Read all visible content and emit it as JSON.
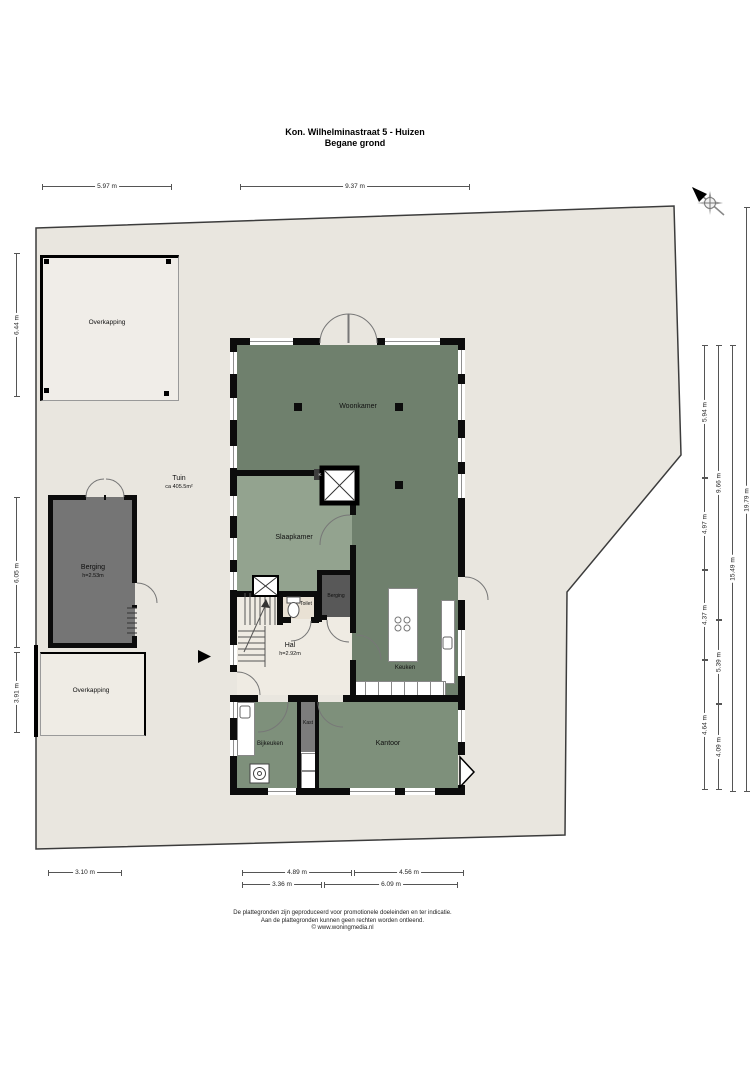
{
  "title": {
    "line1": "Kon. Wilhelminastraat 5 - Huizen",
    "line2": "Begane grond"
  },
  "rooms": {
    "woonkamer": "Woonkamer",
    "slaapkamer": "Slaapkamer",
    "toilet": "Toilet",
    "hal": {
      "name": "Hal",
      "height": "h=2.92m"
    },
    "berging_binnen": "Berging",
    "keuken": "Keuken",
    "bijkeuken": "Bijkeuken",
    "kast": "Kast",
    "kantoor": "Kantoor",
    "meterkast": "K"
  },
  "outside": {
    "overkapping_top": "Overkapping",
    "overkapping_bottom": "Overkapping",
    "berging": {
      "name": "Berging",
      "height": "h=2.53m"
    },
    "tuin": {
      "name": "Tuin",
      "area": "ca 405.5m²"
    }
  },
  "dimensions": [
    {
      "label": "5.97 m",
      "dir": "h",
      "x": 42,
      "y": 186,
      "len": 130
    },
    {
      "label": "9.37 m",
      "dir": "h",
      "x": 240,
      "y": 186,
      "len": 230
    },
    {
      "label": "3.10 m",
      "dir": "h",
      "x": 48,
      "y": 872,
      "len": 74
    },
    {
      "label": "4.89 m",
      "dir": "h",
      "x": 242,
      "y": 872,
      "len": 110
    },
    {
      "label": "4.56 m",
      "dir": "h",
      "x": 354,
      "y": 872,
      "len": 110
    },
    {
      "label": "3.36 m",
      "dir": "h",
      "x": 242,
      "y": 884,
      "len": 80
    },
    {
      "label": "6.09 m",
      "dir": "h",
      "x": 324,
      "y": 884,
      "len": 134
    },
    {
      "label": "6.44 m",
      "dir": "v",
      "x": 16,
      "y": 253,
      "len": 144
    },
    {
      "label": "6.05 m",
      "dir": "v",
      "x": 16,
      "y": 497,
      "len": 151
    },
    {
      "label": "3.91 m",
      "dir": "v",
      "x": 16,
      "y": 652,
      "len": 81
    },
    {
      "label": "5.94 m",
      "dir": "v",
      "x": 704,
      "y": 345,
      "len": 133
    },
    {
      "label": "4.97 m",
      "dir": "v",
      "x": 704,
      "y": 478,
      "len": 92
    },
    {
      "label": "4.37 m",
      "dir": "v",
      "x": 704,
      "y": 570,
      "len": 90
    },
    {
      "label": "4.64 m",
      "dir": "v",
      "x": 704,
      "y": 660,
      "len": 130
    },
    {
      "label": "9.66 m",
      "dir": "v",
      "x": 718,
      "y": 345,
      "len": 275
    },
    {
      "label": "5.39 m",
      "dir": "v",
      "x": 718,
      "y": 620,
      "len": 84
    },
    {
      "label": "4.09 m",
      "dir": "v",
      "x": 718,
      "y": 704,
      "len": 86
    },
    {
      "label": "15.49 m",
      "dir": "v",
      "x": 732,
      "y": 345,
      "len": 447
    },
    {
      "label": "19.79 m",
      "dir": "v",
      "x": 746,
      "y": 207,
      "len": 585
    }
  ],
  "footer": {
    "line1": "De plattegronden zijn geproduceerd voor promotionele doeleinden en ter indicatie.",
    "line2": "Aan de plattegronden kunnen geen rechten worden ontleend.",
    "line3": "© www.woningmedia.nl"
  },
  "compass": "north-arrow",
  "colors": {
    "plot": "#e9e6df",
    "room_dark_green": "#6f806d",
    "room_mid_green": "#7e907b",
    "room_light_green": "#93a38f",
    "hall_floor": "#efebe3",
    "toilet_floor": "#e9e1d4",
    "berging_gray": "#757575",
    "berging_inner_gray": "#585858",
    "wall": "#0c0c0c"
  }
}
